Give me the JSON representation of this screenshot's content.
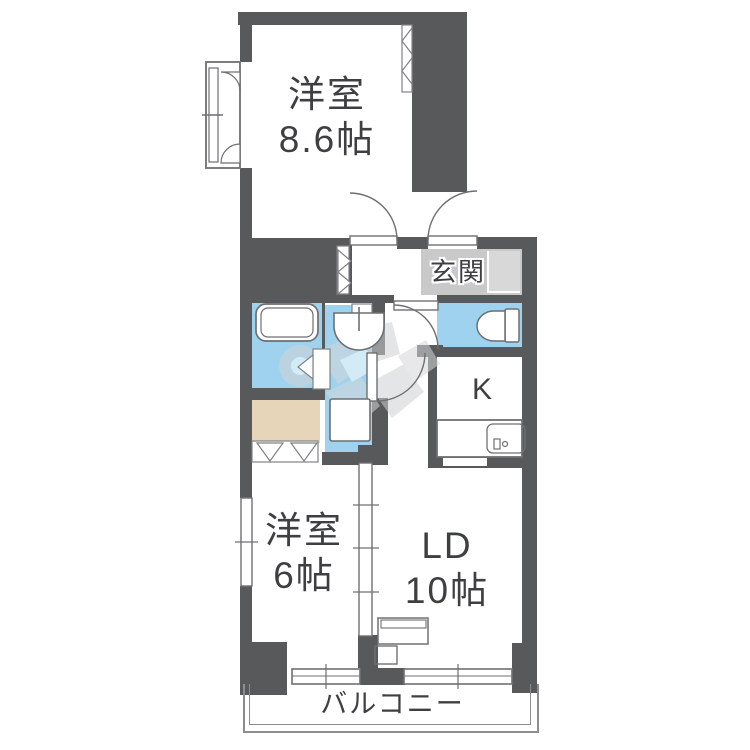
{
  "rooms": {
    "western_top": {
      "line1": "洋室",
      "line2": "8.6帖"
    },
    "western_bottom": {
      "line1": "洋室",
      "line2": "6帖"
    },
    "living_dining": {
      "line1": "LD",
      "line2": "10帖"
    },
    "kitchen": {
      "label": "K"
    },
    "entrance": {
      "label": "玄関"
    },
    "balcony": {
      "label": "バルコニー"
    }
  },
  "colors": {
    "wall": "#58595b",
    "wet_area": "#9fd2ee",
    "closet": "#e7d5ba",
    "entrance_floor": "#c9c9ca",
    "entrance_step": "#d8d8d9",
    "fixture_line": "#6e6f71",
    "label_text": "#3e3f41",
    "background": "#ffffff",
    "watermark": "#d2d3d5"
  },
  "fixtures": [
    "bathtub",
    "washbasin",
    "washing-machine-pan",
    "toilet",
    "kitchen-counter",
    "kitchen-sink",
    "bay-window",
    "casement-windows",
    "sliding-windows",
    "sliding-partition",
    "closet-folding-doors",
    "bathroom-folding-door",
    "swing-doors",
    "tv-board",
    "balcony-rail"
  ]
}
